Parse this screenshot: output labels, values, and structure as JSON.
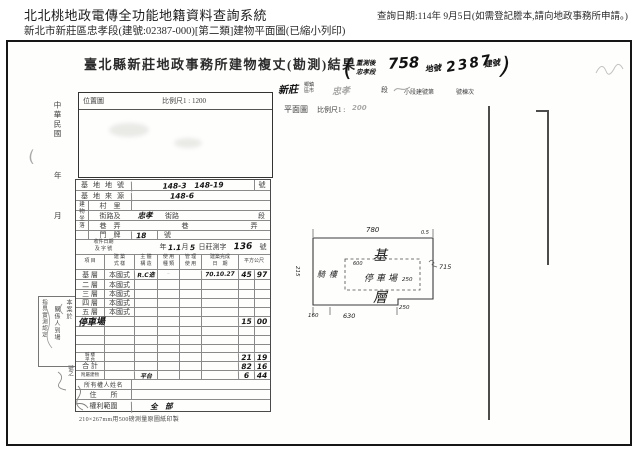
{
  "header": {
    "title": "北北桃地政電傳全功能地籍資料查詢系統",
    "subtitle": "新北市新莊區忠孝段(建號:02387-000)[第二類]建物平面圖(已縮小列印)",
    "query_date": "查詢日期:114年 9月5日(如需登記謄本,請向地政事務所申請。)"
  },
  "scan": {
    "doc_title": "臺北縣新莊地政事務所建物複丈(勘測)結果",
    "location_map": {
      "label": "位置圖",
      "scale": "比例尺1 : 1200"
    },
    "plan_header": {
      "label": "平面圖",
      "scale_label": "比例尺1 :",
      "scale_value": "200"
    },
    "remeasure_note": {
      "open": "(",
      "line1": "重測後",
      "line2": "忠孝段",
      "lot_no": "758",
      "lot_label": "地號",
      "bldg_no": "2387",
      "bldg_label": "建號",
      "close": ")"
    },
    "admin_line": {
      "township_hw": "新莊",
      "township_label": "鄉鎮\n區市",
      "section_hw": "忠孝",
      "section_label": "段",
      "subsection_label": "小段建號第",
      "unit_label": "號棟次"
    },
    "margin": {
      "era": "中華民國",
      "year": "年",
      "month": "月",
      "paren": "(",
      "sheet_no": "號之"
    },
    "case_note": {
      "col1": "本案於",
      "col2": "關係人到場",
      "col3": "指界實測認定"
    },
    "footer": "210×267mm用500磅測量原圖紙印製"
  },
  "plan": {
    "dim_top": "780",
    "dim_corner": "0.5",
    "dim_right": "715",
    "dim_inner_top": "600",
    "dim_inner_right": "250",
    "dim_step": "250",
    "dim_bottom": "630",
    "dim_bottom_left": "160",
    "dim_left": "215",
    "floor_char1": "基",
    "floor_char2": "層",
    "parking": "停車場",
    "arcade": "騎樓"
  },
  "table": {
    "building_location_label": "建物坐落",
    "rows": [
      {
        "h": 11,
        "cells": [
          {
            "w": 55,
            "t": "基地地號",
            "c": "lbl sp"
          },
          {
            "w": 123,
            "t": "148-3   148-19",
            "c": "hw"
          },
          {
            "w": 15,
            "t": "號",
            "c": "lbl"
          }
        ]
      },
      {
        "h": 10,
        "cells": [
          {
            "w": 55,
            "t": "基地來源",
            "c": "lbl sp"
          },
          {
            "w": 138,
            "t": "148-6",
            "c": "hw pl38"
          }
        ]
      },
      {
        "h": 10,
        "cells": [
          {
            "w": 12
          },
          {
            "w": 43,
            "t": "村　里",
            "c": "lbl"
          },
          {
            "w": 138
          }
        ]
      },
      {
        "h": 10,
        "cells": [
          {
            "w": 12
          },
          {
            "w": 43,
            "t": "街路及",
            "c": "lbl"
          },
          {
            "w": 28,
            "t": "忠孝",
            "c": "hw nb"
          },
          {
            "w": 26,
            "t": "街路",
            "c": "lbl nb"
          },
          {
            "w": 69,
            "c": "nb"
          },
          {
            "w": 15,
            "t": "段",
            "c": "lbl nb"
          }
        ]
      },
      {
        "h": 10,
        "cells": [
          {
            "w": 12
          },
          {
            "w": 43,
            "t": "巷　弄",
            "c": "lbl"
          },
          {
            "w": 108,
            "t": "巷",
            "c": "lbl nb"
          },
          {
            "w": 30,
            "t": "弄",
            "c": "lbl nb"
          }
        ]
      },
      {
        "h": 9,
        "cells": [
          {
            "w": 12
          },
          {
            "w": 43,
            "t": "門　牌",
            "c": "lbl"
          },
          {
            "w": 26,
            "t": "18",
            "c": "hw pl4"
          },
          {
            "w": 24,
            "t": "號",
            "c": "lbl pl6"
          },
          {
            "w": 88,
            "c": "nb"
          }
        ]
      },
      {
        "h": 15,
        "cells": [
          {
            "w": 55,
            "t": "收件日期\n及 字 號",
            "c": "lbl tiny2"
          },
          {
            "w": 27,
            "c": "nb"
          },
          {
            "w": 10,
            "t": "年",
            "c": "lbl nb"
          },
          {
            "w": 8,
            "t": "1.",
            "c": "hw nb"
          },
          {
            "w": 5,
            "t": "1",
            "c": "hw nb"
          },
          {
            "w": 8,
            "t": "月",
            "c": "lbl nb"
          },
          {
            "w": 7,
            "t": "5",
            "c": "hw nb"
          },
          {
            "w": 33,
            "t": "日莊測字",
            "c": "lbl nb"
          },
          {
            "w": 28,
            "t": "136",
            "c": "hw big nb"
          },
          {
            "w": 12,
            "t": "號",
            "c": "lbl nb"
          }
        ]
      },
      {
        "h": 15,
        "cells": [
          {
            "w": 28,
            "t": "項 目",
            "c": "lbl tiny2"
          },
          {
            "w": 30,
            "t": "建 築\n式 樣",
            "c": "lbl tiny2"
          },
          {
            "w": 23,
            "t": "主 體\n構 造",
            "c": "lbl tiny2"
          },
          {
            "w": 22,
            "t": "使 用\n種 類",
            "c": "lbl tiny2"
          },
          {
            "w": 22,
            "t": "管 理\n使 用",
            "c": "lbl tiny2"
          },
          {
            "w": 37,
            "t": "建築完成\n日　期",
            "c": "lbl tiny2"
          },
          {
            "w": 31,
            "t": "平方公尺",
            "c": "lbl tiny2"
          }
        ]
      },
      {
        "h": 10,
        "cells": [
          {
            "w": 28,
            "t": "基 層",
            "c": "lbl"
          },
          {
            "w": 30,
            "t": "本國式",
            "c": "lbl"
          },
          {
            "w": 23,
            "t": "R.C造",
            "c": "hw t7"
          },
          {
            "w": 22,
            "t": "~",
            "c": "faint"
          },
          {
            "w": 22
          },
          {
            "w": 37,
            "t": "70.10.27",
            "c": "hw t7"
          },
          {
            "w": 16,
            "t": "45",
            "c": "hw"
          },
          {
            "w": 15,
            "t": "97",
            "c": "hw"
          }
        ]
      },
      {
        "h": 10,
        "cells": [
          {
            "w": 28,
            "t": "二 層",
            "c": "lbl"
          },
          {
            "w": 30,
            "t": "本國式",
            "c": "lbl"
          },
          {
            "w": 23
          },
          {
            "w": 22
          },
          {
            "w": 22
          },
          {
            "w": 37
          },
          {
            "w": 16
          },
          {
            "w": 15
          }
        ]
      },
      {
        "h": 9,
        "cells": [
          {
            "w": 28,
            "t": "三 層",
            "c": "lbl"
          },
          {
            "w": 30,
            "t": "本國式",
            "c": "lbl"
          },
          {
            "w": 23
          },
          {
            "w": 22
          },
          {
            "w": 22
          },
          {
            "w": 37
          },
          {
            "w": 16
          },
          {
            "w": 15
          }
        ]
      },
      {
        "h": 9,
        "cells": [
          {
            "w": 28,
            "t": "四 層",
            "c": "lbl"
          },
          {
            "w": 30,
            "t": "本國式",
            "c": "lbl"
          },
          {
            "w": 23
          },
          {
            "w": 22
          },
          {
            "w": 22
          },
          {
            "w": 37
          },
          {
            "w": 16
          },
          {
            "w": 15
          }
        ]
      },
      {
        "h": 9,
        "cells": [
          {
            "w": 28,
            "t": "五 層",
            "c": "lbl"
          },
          {
            "w": 30,
            "t": "本國式",
            "c": "lbl"
          },
          {
            "w": 23
          },
          {
            "w": 22
          },
          {
            "w": 22
          },
          {
            "w": 37
          },
          {
            "w": 16
          },
          {
            "w": 15
          }
        ]
      },
      {
        "h": 10,
        "cells": [
          {
            "w": 28,
            "t": "停車場",
            "c": "hw ov"
          },
          {
            "w": 30
          },
          {
            "w": 23
          },
          {
            "w": 22
          },
          {
            "w": 22
          },
          {
            "w": 37
          },
          {
            "w": 16,
            "t": "15",
            "c": "hw"
          },
          {
            "w": 15,
            "t": "00",
            "c": "hw"
          }
        ]
      },
      {
        "h": 9,
        "cells": [
          {
            "w": 28
          },
          {
            "w": 30
          },
          {
            "w": 23
          },
          {
            "w": 22
          },
          {
            "w": 22
          },
          {
            "w": 37
          },
          {
            "w": 16
          },
          {
            "w": 15
          }
        ]
      },
      {
        "h": 9,
        "cells": [
          {
            "w": 28
          },
          {
            "w": 30
          },
          {
            "w": 23
          },
          {
            "w": 22
          },
          {
            "w": 22
          },
          {
            "w": 37
          },
          {
            "w": 16
          },
          {
            "w": 15
          }
        ]
      },
      {
        "h": 8,
        "cells": [
          {
            "w": 28
          },
          {
            "w": 30
          },
          {
            "w": 23
          },
          {
            "w": 22
          },
          {
            "w": 22
          },
          {
            "w": 37
          },
          {
            "w": 16
          },
          {
            "w": 15
          }
        ]
      },
      {
        "h": 9,
        "cells": [
          {
            "w": 28,
            "t": "騎 樓\n平 台",
            "c": "lbl tiny1"
          },
          {
            "w": 30
          },
          {
            "w": 23
          },
          {
            "w": 22
          },
          {
            "w": 22
          },
          {
            "w": 37
          },
          {
            "w": 16,
            "t": "21",
            "c": "hw"
          },
          {
            "w": 15,
            "t": "19",
            "c": "hw"
          }
        ]
      },
      {
        "h": 9,
        "cells": [
          {
            "w": 28,
            "t": "合 計",
            "c": "lbl"
          },
          {
            "w": 30
          },
          {
            "w": 23
          },
          {
            "w": 22
          },
          {
            "w": 22
          },
          {
            "w": 37
          },
          {
            "w": 16,
            "t": "82",
            "c": "hw"
          },
          {
            "w": 15,
            "t": "16",
            "c": "hw"
          }
        ]
      },
      {
        "h": 9,
        "cells": [
          {
            "w": 28,
            "t": "附屬建物",
            "c": "lbl tiny1"
          },
          {
            "w": 30
          },
          {
            "w": 23,
            "t": "平台",
            "c": "hw t7"
          },
          {
            "w": 22
          },
          {
            "w": 22
          },
          {
            "w": 37
          },
          {
            "w": 16,
            "t": "6",
            "c": "hw"
          },
          {
            "w": 15,
            "t": "44",
            "c": "hw"
          }
        ]
      },
      {
        "h": 10,
        "cells": [
          {
            "w": 55,
            "t": "所有權人姓名",
            "c": "lbl t6"
          },
          {
            "w": 138
          }
        ]
      },
      {
        "h": 10,
        "cells": [
          {
            "w": 55,
            "t": "住　　所",
            "c": "lbl"
          },
          {
            "w": 138
          }
        ]
      },
      {
        "h": 11,
        "cells": [
          {
            "w": 55,
            "t": "權利範圍",
            "c": "lbl"
          },
          {
            "w": 138,
            "t": "全　部",
            "c": "hw pl18"
          }
        ]
      }
    ]
  }
}
